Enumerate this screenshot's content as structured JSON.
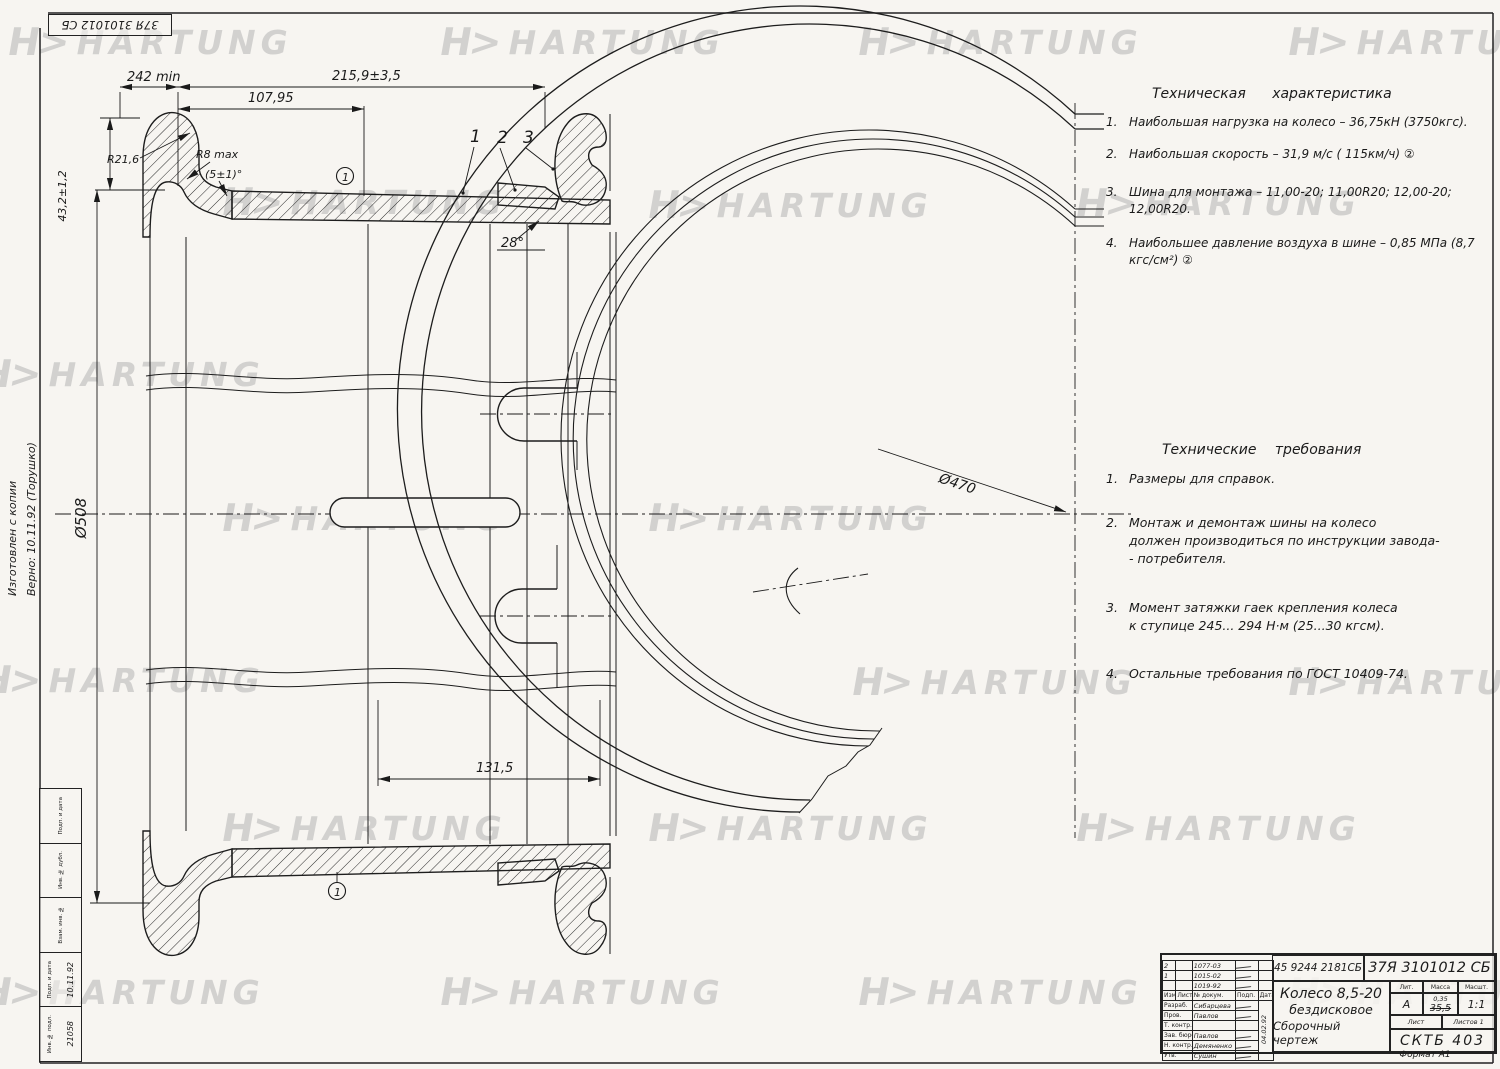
{
  "corner_stamp": {
    "text": "37Я 3101012 СБ"
  },
  "watermark": {
    "logo": "H>",
    "brand": "HARTUNG"
  },
  "side_note": {
    "line1": "Изготовлен с копии",
    "line2": "Верно: 10.11.92 (Торушко)"
  },
  "margin_stamp": {
    "labels": [
      "Подп. и дата",
      "Инв. № дубл.",
      "Взам. инв. №",
      "Подп. и дата",
      "Инв. № подл."
    ],
    "sign_date": "10.11.92",
    "inv_number": "21058"
  },
  "dimensions": {
    "d242": "242 min",
    "d2159": "215,9±3,5",
    "d10795": "107,95",
    "d432": "43,2±1,2",
    "r216": "R21,6",
    "r8": "R8 max",
    "a5": "(5±1)°",
    "a28": "28°",
    "d508": "Ø508",
    "d1315": "131,5",
    "d470": "Ø470",
    "callout1": "1",
    "callout2": "2",
    "callout3": "3",
    "pos1": "1"
  },
  "tech_characteristics": {
    "title": "Техническая характеристика",
    "items": [
      {
        "num": "1.",
        "text": "Наибольшая нагрузка на колесо – 36,75кН (3750кгс)."
      },
      {
        "num": "2.",
        "text": "Наибольшая скорость – 31,9 м/с ( 115км/ч) ②"
      },
      {
        "num": "3.",
        "text": "Шина для монтажа – 11,00-20; 11,00R20; 12,00-20; 12,00R20."
      },
      {
        "num": "4.",
        "text": "Наибольшее давление воздуха в шине – 0,85 МПа (8,7 кгс/см²) ②"
      }
    ]
  },
  "tech_requirements": {
    "title": "Технические требования",
    "items": [
      {
        "num": "1.",
        "text": "Размеры для справок."
      },
      {
        "num": "2.",
        "text": "Монтаж и демонтаж шины на колесо\nдолжен производиться по инструкции завода-\n- потребителя."
      },
      {
        "num": "3.",
        "text": "Момент затяжки гаек крепления колеса\nк ступице 245... 294 Н·м (25...30 кгсм)."
      },
      {
        "num": "4.",
        "text": "Остальные требования по ГОСТ 10409-74."
      }
    ]
  },
  "title_block": {
    "doc_number": "45 9244 2181СБ",
    "designation": "37Я 3101012 СБ",
    "title_line1": "Колесо 8,5-20",
    "title_line2": "бездисковое",
    "title_line3": "Сборочный чертеж",
    "rev_rows": [
      {
        "izm": "2",
        "doc": "1077-03"
      },
      {
        "izm": "1",
        "doc": "1015-02"
      },
      {
        "izm": "",
        "doc": "1019-92"
      }
    ],
    "header_cells": [
      "Изм",
      "Лист",
      "№ докум.",
      "Подп.",
      "Дата"
    ],
    "sign_rows": [
      {
        "role": "Разраб.",
        "name": "Сибарцева"
      },
      {
        "role": "Пров.",
        "name": "Павлов"
      },
      {
        "role": "Т. контр.",
        "name": ""
      },
      {
        "role": "Зав. бюро",
        "name": "Павлов"
      },
      {
        "role": "Н. контр.",
        "name": "Демяненко"
      },
      {
        "role": "Утв.",
        "name": "Сушин"
      }
    ],
    "date_note": "04.02.92",
    "lit_label": "Лит.",
    "lit_value": "А",
    "mass_label": "Масса",
    "mass_old": "0,35",
    "mass_value": "35,5",
    "scale_label": "Масшт.",
    "scale_value": "1:1",
    "sheet_label": "Лист",
    "sheets_label": "Листов 1",
    "org": "СКТБ 403",
    "format_note": "Формат А1"
  }
}
